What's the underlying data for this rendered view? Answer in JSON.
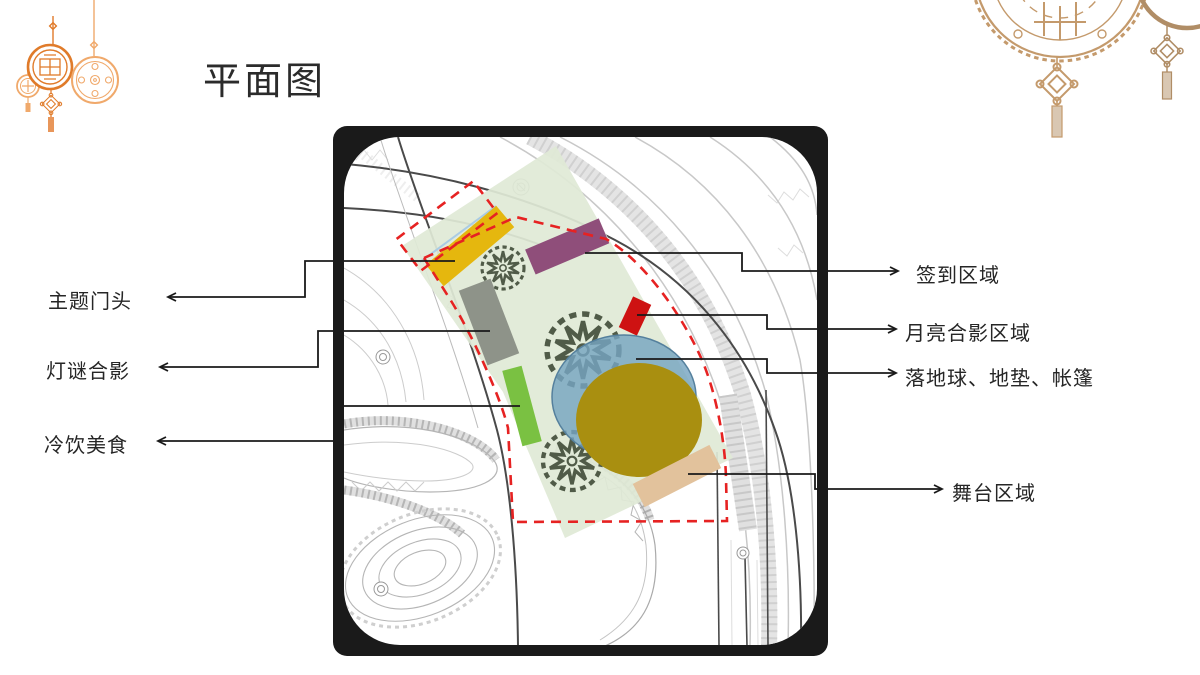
{
  "slide": {
    "title": "平面图",
    "background_color": "#ffffff"
  },
  "plan": {
    "frame_color": "#1a1a1a",
    "map_paper_color": "#ffffff",
    "event_zone_overlay_color": "#dfe9d6",
    "boundary_dash_color": "#e62222",
    "callout_line_color": "#1a1a1a",
    "areas": [
      {
        "id": "theme-gate",
        "label": "主题门头",
        "marker_shape": "rect",
        "marker_color": "#e5b70e",
        "label_side": "left"
      },
      {
        "id": "lantern-riddle-photo",
        "label": "灯谜合影",
        "marker_shape": "rect",
        "marker_color": "#8e9389",
        "label_side": "left"
      },
      {
        "id": "cold-drinks-food",
        "label": "冷饮美食",
        "marker_shape": "rect",
        "marker_color": "#7ac142",
        "label_side": "left"
      },
      {
        "id": "sign-in-area",
        "label": "签到区域",
        "marker_shape": "rect",
        "marker_color": "#8f4e7a",
        "label_side": "right"
      },
      {
        "id": "moon-photo-area",
        "label": "月亮合影区域",
        "marker_shape": "rect",
        "marker_color": "#ce1212",
        "label_side": "right"
      },
      {
        "id": "ground-globe-mats-tents",
        "label": "落地球、地垫、帐篷",
        "marker_shape": "ellipse",
        "marker_color": "#76a5c1",
        "label_side": "right"
      },
      {
        "id": "stage-area",
        "label": "舞台区域",
        "marker_shape": "rect",
        "marker_color": "#e2c29c",
        "label_side": "right"
      }
    ],
    "other_map_colors": {
      "globe_gold": "#a98f10",
      "tree_symbol_green": "#37432f",
      "road_line_gray": "#c8c8c8",
      "road_line_dark": "#4a4a4a"
    }
  },
  "decorations": {
    "left_ornaments": {
      "name": "hanging-lantern-medallions",
      "colors": [
        "#e07b2a",
        "#f0a96b"
      ]
    },
    "right_ornaments": {
      "name": "mooncake-with-chinese-knots",
      "color": "#c49a6c"
    }
  }
}
